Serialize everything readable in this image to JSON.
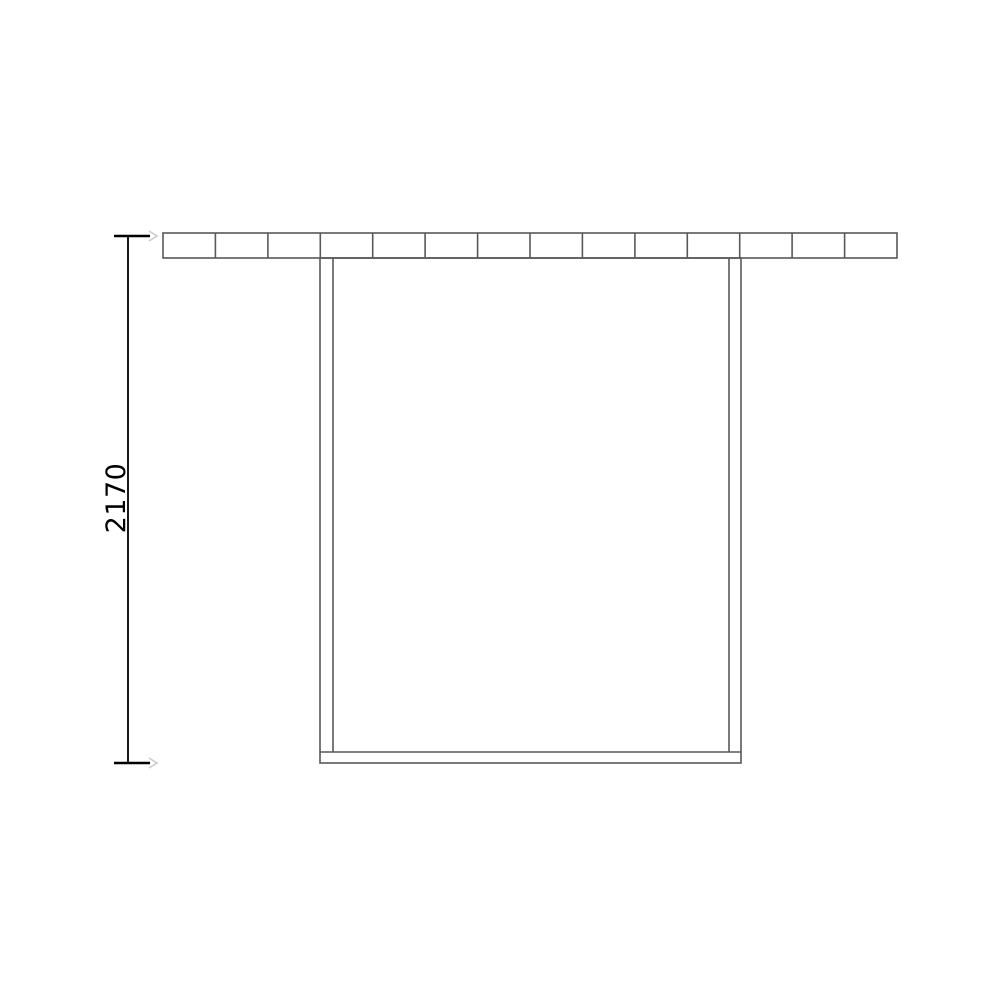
{
  "drawing": {
    "dimension": {
      "label": "2170"
    },
    "top_rail": {
      "segments": 14
    },
    "colors": {
      "outline": "#58585a",
      "dimension": "#000000",
      "accent_tick": "#cccccc",
      "background": "#ffffff"
    }
  }
}
